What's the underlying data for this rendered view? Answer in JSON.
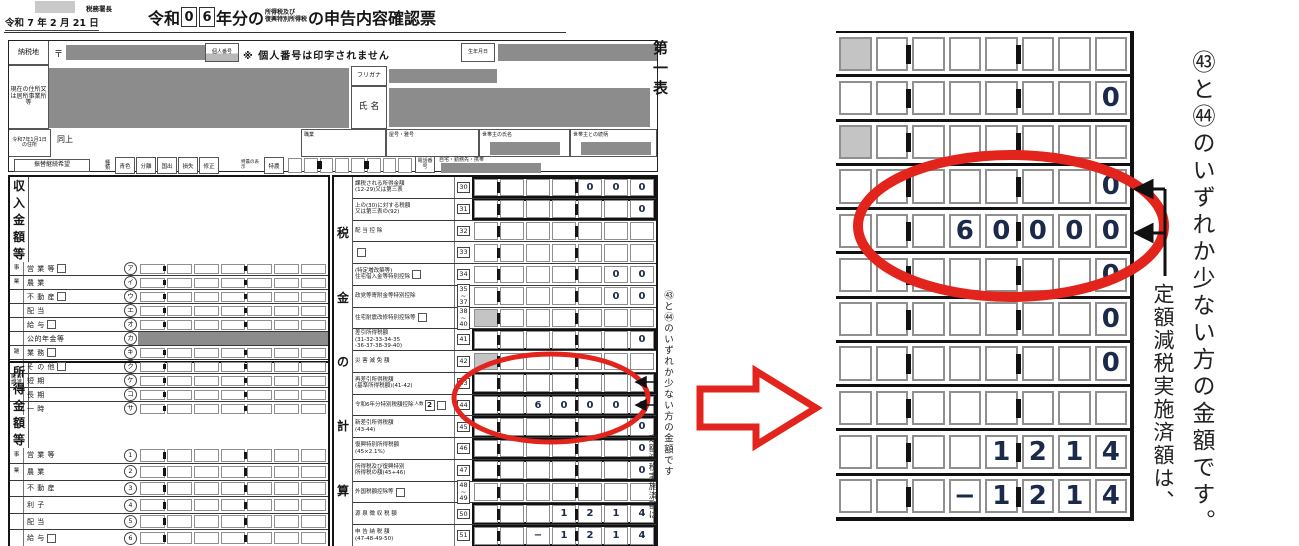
{
  "page": {
    "tax_office": "税務署長",
    "date_line": "令和 7 年 2 月 21 日",
    "title": {
      "era": "令和",
      "year_digits": [
        "0",
        "6"
      ],
      "mid": "年分の",
      "tax_small_1": "所得税及び",
      "tax_small_2": "復興特別所得税",
      "suffix": "の申告内容確認票"
    },
    "first_table_label": "第一表"
  },
  "header": {
    "nozeichi": "納税地",
    "postal_mark": "〒",
    "kojin_bango": "個人番号",
    "kojin_note": "※ 個人番号は印字されません",
    "birth_label": "生年月日",
    "current_address_label": "現在の住所又は居所事業所等",
    "furigana_label": "フリガナ",
    "name_label": "氏 名",
    "jan1_label": "令和7年1月1日の住所",
    "same_as_above": "同上",
    "occupation_label": "職業",
    "trade_name_label": "屋号・雅号",
    "householder_label": "世帯主の氏名",
    "relation_label": "世帯主との続柄",
    "furikae_label": "振替継続希望",
    "type_label": "種類",
    "type_options": [
      "青色",
      "分離",
      "国出",
      "損失",
      "修正"
    ],
    "tokuno_note": "特農の表示",
    "tokuno_label": "特農",
    "phone_label": "電話番号",
    "phone_note": "自宅・勤務先・携帯"
  },
  "income_section": {
    "title_chars": [
      "収",
      "入",
      "金",
      "額",
      "等"
    ],
    "rows": [
      {
        "group": "事",
        "label": "営 業 等",
        "kubun": true,
        "code": "ア",
        "value": ""
      },
      {
        "group": "業",
        "label": "農 業",
        "code": "イ",
        "value": ""
      },
      {
        "group": "",
        "label": "不 動 産",
        "kubun": true,
        "code": "ウ",
        "value": ""
      },
      {
        "group": "",
        "label": "配 当",
        "code": "エ",
        "value": ""
      },
      {
        "group": "",
        "label": "給 与",
        "kubun": true,
        "code": "オ",
        "value": ""
      },
      {
        "group": "",
        "label": "公的年金等",
        "code": "カ",
        "value": "",
        "grayval": true
      },
      {
        "group": "雑",
        "label": "業 務",
        "kubun": true,
        "code": "キ",
        "value": ""
      },
      {
        "group": "",
        "label": "そ の 他",
        "kubun": true,
        "code": "ク",
        "value": ""
      },
      {
        "group": "総合譲渡",
        "label": "短 期",
        "code": "ケ",
        "value": ""
      },
      {
        "group": "",
        "label": "長 期",
        "code": "コ",
        "value": ""
      },
      {
        "group": "",
        "label": "一 時",
        "code": "サ",
        "value": ""
      }
    ]
  },
  "income2_section": {
    "title_chars": [
      "所",
      "得",
      "金",
      "額",
      "等"
    ],
    "rows": [
      {
        "group": "事",
        "label": "営 業 等",
        "code": "1",
        "value": ""
      },
      {
        "group": "業",
        "label": "農 業",
        "code": "2",
        "value": ""
      },
      {
        "group": "",
        "label": "不 動 産",
        "code": "3",
        "value": ""
      },
      {
        "group": "",
        "label": "利 子",
        "code": "4",
        "value": ""
      },
      {
        "group": "",
        "label": "配 当",
        "code": "5",
        "value": ""
      },
      {
        "group": "",
        "label": "給 与",
        "kubun": true,
        "code": "6",
        "value": ""
      }
    ]
  },
  "tax_section": {
    "title_chars": [
      "税",
      "金",
      "の",
      "計",
      "算"
    ],
    "rows": [
      {
        "num": "30",
        "label": "課税される所得金額\n(12-29)又は第三表",
        "value": "000",
        "bold": true
      },
      {
        "num": "31",
        "label": "上の(30)に対する税額\n又は第三表の(92)",
        "value": "0",
        "bold": true
      },
      {
        "num": "32",
        "label": "配 当 控 除",
        "value": ""
      },
      {
        "num": "33",
        "label": "",
        "kubun": true,
        "value": ""
      },
      {
        "num": "34",
        "label": "(特定増改築等)\n住宅借入金等特別控除",
        "kubun": true,
        "value": "00"
      },
      {
        "num": "35\n~\n37",
        "label": "政党等寄附金等特別控除",
        "value": "00"
      },
      {
        "num": "38\n~\n40",
        "label": "住宅耐震改修特別控除等",
        "kubun": true,
        "value": "",
        "gray_first": true
      },
      {
        "num": "41",
        "label": "差引所得税額\n(31-32-33-34-35\n-36-37-38-39-40)",
        "value": "0",
        "bold": true
      },
      {
        "num": "42",
        "label": "災 害 減 免 額",
        "value": "",
        "gray_first": true
      },
      {
        "num": "43",
        "label": "再差引所得税額\n(基準所得税額)(41-42)",
        "value": "0",
        "bold": true,
        "arrow": true
      },
      {
        "num": "44",
        "label": "令和6年分特別税額控除",
        "persons_label": "人数",
        "persons": "2",
        "kubun": true,
        "value": "60000",
        "bold": true,
        "arrow": true
      },
      {
        "num": "45",
        "label": "新差引所得税額\n(43-44)",
        "value": "0",
        "bold": true
      },
      {
        "num": "46",
        "label": "復興特別所得税額\n(45×2.1%)",
        "value": "0",
        "bold": true
      },
      {
        "num": "47",
        "label": "所得税及び復興特別\n所得税の額(45+46)",
        "value": "0",
        "bold": true
      },
      {
        "num": "48\n~\n49",
        "label": "外国税額控除等",
        "kubun": true,
        "value": ""
      },
      {
        "num": "50",
        "label": "源 泉 徴 収 税 額",
        "value": "1214",
        "bold": true
      },
      {
        "num": "51",
        "label": "申 告 納 税 額\n(47-48-49-50)",
        "value": "−1214",
        "bold": true
      }
    ]
  },
  "zoom_panel": {
    "rows": [
      {
        "value": "",
        "gray_first": true
      },
      {
        "value": "0"
      },
      {
        "value": "",
        "gray_first": true
      },
      {
        "value": "0",
        "arrow": true
      },
      {
        "value": "60000",
        "arrow": true
      },
      {
        "value": "0"
      },
      {
        "value": "0"
      },
      {
        "value": "0"
      },
      {
        "value": ""
      },
      {
        "value": "1214"
      },
      {
        "value": "−1214"
      }
    ]
  },
  "annotations": {
    "note_main": "㊸と㊹のいずれか少ない方の金額です。",
    "note_sub": "定額減税実施済額は、",
    "note_main_small": "㊸と㊹のいずれか少ない方の金額です",
    "note_sub_small": "定額減税実施済額は"
  },
  "colors": {
    "red": "#e3241c",
    "redaction_gray": "#8c8c8c",
    "cell_border": "#8e8e8e",
    "digit_navy": "#1c2a4a",
    "line_black": "#161616",
    "light_gray": "#c8c8c8"
  }
}
